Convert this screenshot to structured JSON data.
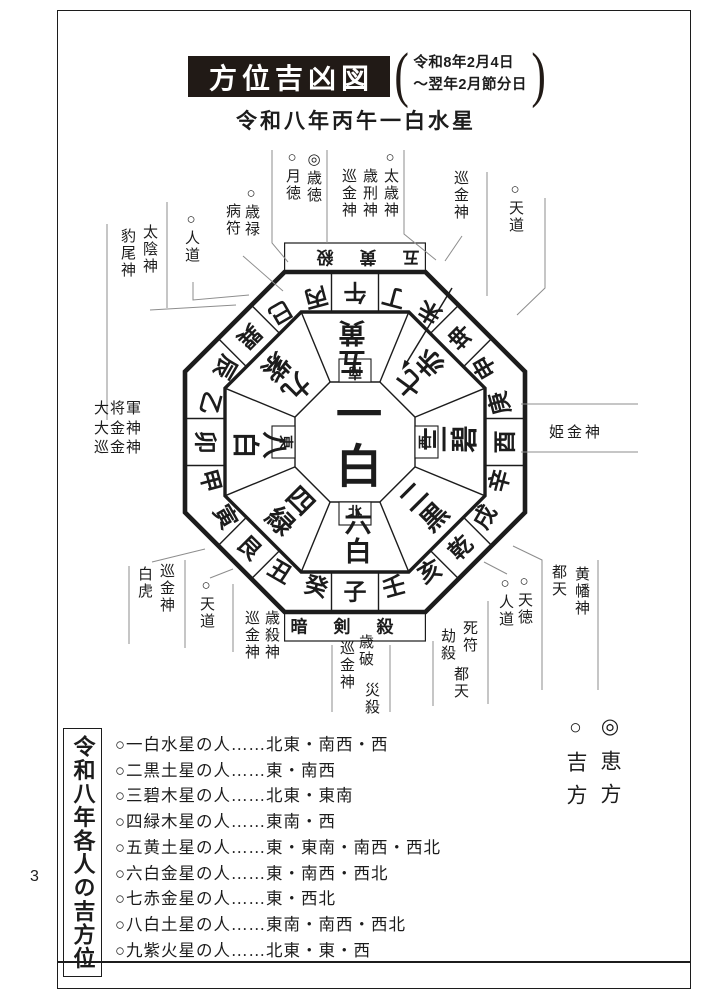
{
  "page_number": "3",
  "header": {
    "title": "方位吉凶図",
    "period_line1": "令和8年2月4日",
    "period_line2": "〜翌年2月節分日",
    "year_star": "令和八年丙午一白水星"
  },
  "diagram": {
    "band_top": "五黄殺",
    "band_bottom": "暗剣殺",
    "center_star": "一白",
    "dirs": [
      "南",
      "北",
      "東",
      "西"
    ],
    "ring": [
      "丙",
      "午",
      "丁",
      "未",
      "坤",
      "申",
      "庚",
      "酉",
      "辛",
      "戌",
      "乾",
      "亥",
      "壬",
      "子",
      "癸",
      "丑",
      "艮",
      "寅",
      "甲",
      "卯",
      "乙",
      "辰",
      "巽",
      "巳"
    ],
    "stars": [
      "五黄",
      "七赤",
      "三碧",
      "二黒",
      "六白",
      "四緑",
      "八白",
      "九紫"
    ],
    "labels": {
      "hyobijin": "豹尾神",
      "taionjin": "太陰神",
      "jindo_nw": "○人道",
      "byofu": "病符",
      "sairoku": "○歳禄",
      "gettoku": "○月徳",
      "saitoku": "◎歳徳",
      "junkonjin_taisai": "巡金神",
      "saikeijin": "歳刑神",
      "taisaijin": "○太歳神",
      "junkonjin_top_right": "巡金神",
      "tendo_top": "○天道",
      "daishogun": "大将軍",
      "daikonjin": "大金神",
      "junkonjin_east": "巡金神",
      "himekonjin": "姫金神",
      "byakko": "白虎",
      "junkonjin_sw": "巡金神",
      "tendo_bottom": "○天道",
      "saisetsujin": "歳殺神",
      "junkonjin_ushi": "巡金神",
      "saiha": "歳破",
      "saisatsu": "災殺",
      "junkonjin_north": "巡金神",
      "shifu": "死符",
      "kosatsu": "劫殺",
      "toten_inner": "都天",
      "tentoku": "○天徳",
      "jindo_se": "○人道",
      "toten_outer": "都天",
      "obanjin": "黄幡神"
    }
  },
  "legend": {
    "eho": "◎恵方",
    "kichiho": "○吉方"
  },
  "good_directions": {
    "box_title": "令和八年各人の吉方位",
    "rows": [
      "○一白水星の人……北東・南西・西",
      "○二黒土星の人……東・南西",
      "○三碧木星の人……北東・東南",
      "○四緑木星の人……東南・西",
      "○五黄土星の人……東・東南・南西・西北",
      "○六白金星の人……東・南西・西北",
      "○七赤金星の人……東・西北",
      "○八白土星の人……東南・南西・西北",
      "○九紫火星の人……北東・東・西"
    ]
  }
}
